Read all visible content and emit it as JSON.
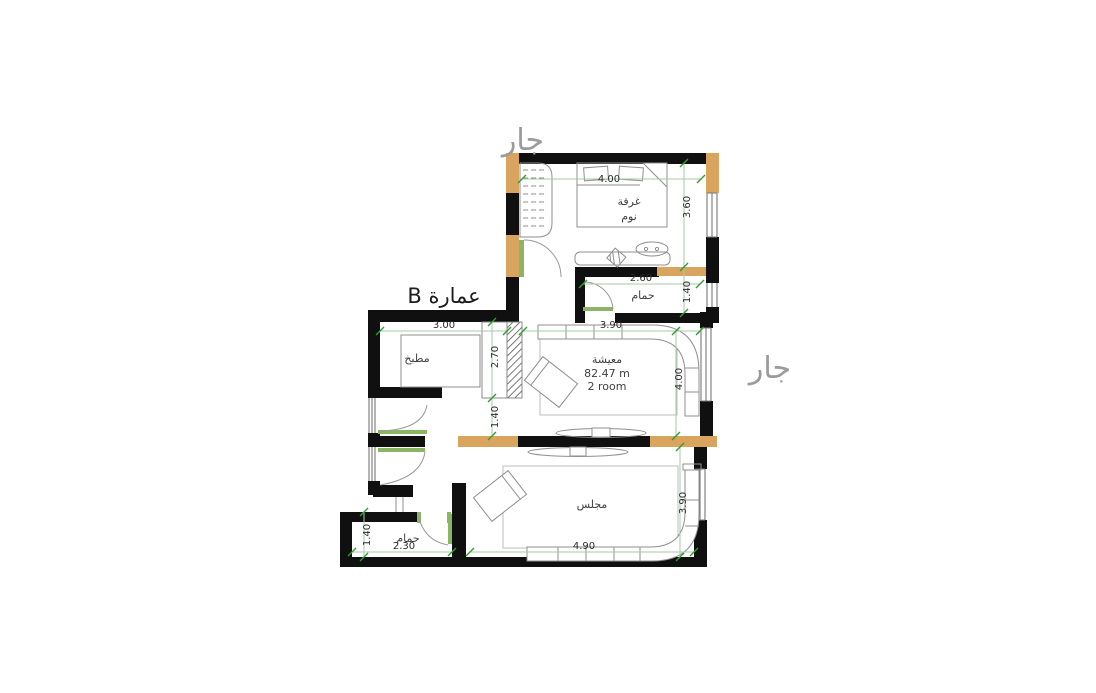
{
  "plan": {
    "labels": {
      "neighbor_top": "جار",
      "neighbor_right": "جار",
      "building": "عمارة B",
      "bedroom_l1": "غرفة",
      "bedroom_l2": "نوم",
      "bath_top": "حمام",
      "kitchen": "مطبخ",
      "living": "معيشة",
      "living_area": "82.47 m",
      "living_rooms": "2 room",
      "majlis": "مجلس",
      "bath_bottom": "حمام"
    },
    "dims": {
      "bedroom_w": "4.00",
      "bedroom_h": "3.60",
      "bath_top_w": "2.60",
      "bath_top_h": "1.40",
      "kitchen_w": "3.00",
      "kitchen_h": "2.70",
      "hall_h": "1.40",
      "living_w": "3.90",
      "living_h": "4.00",
      "majlis_w": "4.90",
      "majlis_h": "3.90",
      "bath_bottom_w": "2.30",
      "bath_bottom_h": "1.40"
    }
  },
  "colors": {
    "wall": "#101010",
    "wood": "#d9a55e",
    "door": "#8bb563",
    "dim_tick": "#2f9e2f",
    "dim_line": "#a9c9a9",
    "furniture": "#8f8f8f",
    "neighbor_text": "#9b9b9b",
    "label_text": "#3f3f3f"
  }
}
